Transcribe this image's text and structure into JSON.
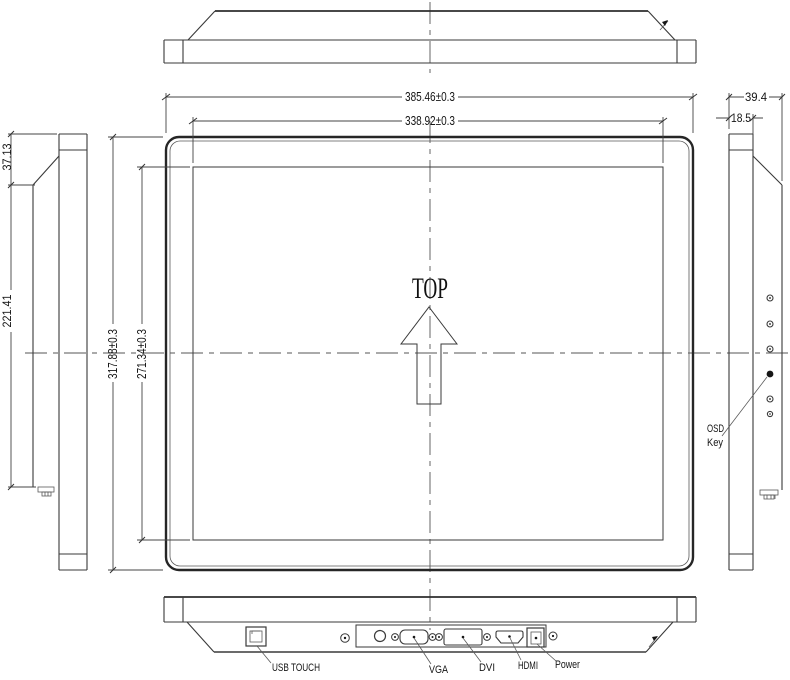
{
  "drawing": {
    "front_view": {
      "orientation_label": "TOP"
    },
    "dims": {
      "overall_width": "385.46±0.3",
      "panel_width": "338.92±0.3",
      "overall_height": "317.88±0.3",
      "panel_height": "271.34±0.3",
      "side_top_offset": "37.13",
      "side_back_height": "221.41",
      "overall_depth": "39.4",
      "front_depth": "18.5"
    },
    "right_view": {
      "osd_label_line1": "OSD",
      "osd_label_line2": "Key"
    },
    "bottom_view": {
      "usb_label": "USB TOUCH",
      "vga_label": "VGA",
      "dvi_label": "DVI",
      "hdmi_label": "HDMI",
      "power_label": "Power"
    },
    "colors": {
      "line": "#3a3a3a",
      "thick_line": "#262626",
      "background": "#ffffff",
      "text": "#141414"
    }
  }
}
